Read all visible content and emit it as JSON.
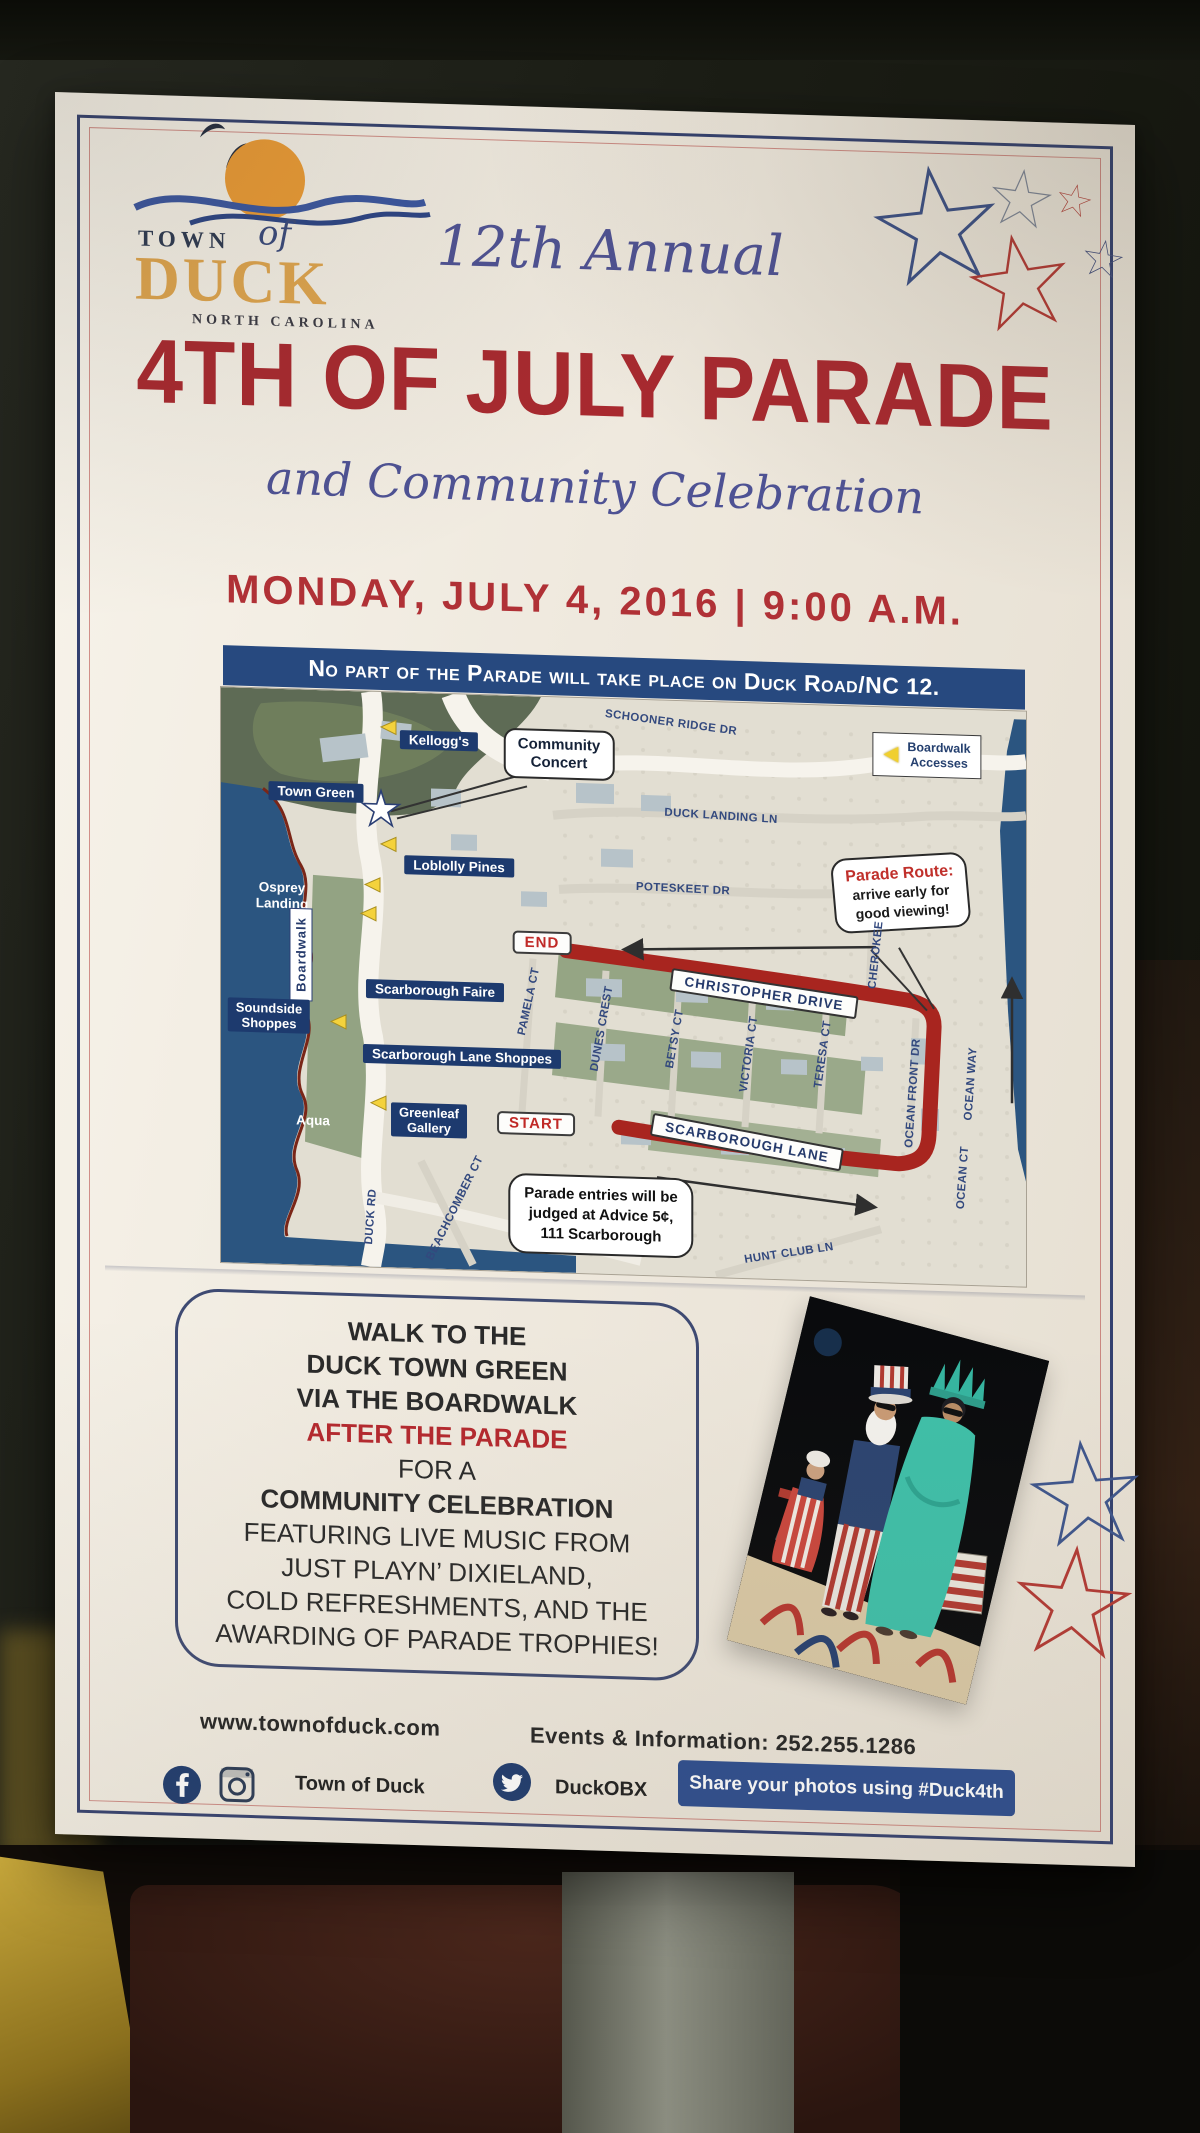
{
  "poster": {
    "logo": {
      "town": "TOWN",
      "of": "of",
      "name": "DUCK",
      "region": "NORTH CAROLINA"
    },
    "edition": "12th Annual",
    "title": "4TH OF JULY PARADE",
    "subtitle": "and Community Celebration",
    "date_line": "MONDAY, JULY 4, 2016 | 9:00 A.M.",
    "notice": "No part of the Parade will take place on Duck Road/NC 12.",
    "map": {
      "legend": {
        "line1": "Boardwalk",
        "line2": "Accesses"
      },
      "badges": {
        "end": "END",
        "start": "START"
      },
      "banners": {
        "christopher": "CHRISTOPHER DRIVE",
        "scarborough": "SCARBOROUGH LANE"
      },
      "callouts": {
        "concert": {
          "line1": "Community",
          "line2": "Concert"
        },
        "route": {
          "title": "Parade Route:",
          "line1": "arrive early for",
          "line2": "good viewing!"
        },
        "judging": {
          "line1": "Parade entries will be",
          "line2": "judged at Advice 5¢,",
          "line3": "111 Scarborough"
        }
      },
      "places": {
        "kelloggs": "Kellogg's",
        "town_green": "Town Green",
        "loblolly": "Loblolly Pines",
        "osprey": {
          "line1": "Osprey",
          "line2": "Landing"
        },
        "boardwalk": "Boardwalk",
        "soundside": {
          "line1": "Soundside",
          "line2": "Shoppes"
        },
        "faire": "Scarborough Faire",
        "lane_shoppes": "Scarborough Lane Shoppes",
        "greenleaf": {
          "line1": "Greenleaf",
          "line2": "Gallery"
        },
        "aqua": "Aqua"
      },
      "streets": {
        "schooner": "SCHOONER RIDGE DR",
        "duck_landing": "DUCK LANDING LN",
        "poteskeet": "POTESKEET DR",
        "cherokee": "CHEROKEE",
        "pamela": "PAMELA CT",
        "dunes": "DUNES CREST",
        "betsy": "BETSY CT",
        "victoria": "VICTORIA CT",
        "teresa": "TERESA CT",
        "ocean_front": "OCEAN FRONT DR",
        "ocean_way": "OCEAN WAY",
        "ocean_ct": "OCEAN CT",
        "duck_rd": "DUCK RD",
        "beachcomber": "BEACHCOMBER CT",
        "hunt_club": "HUNT CLUB LN"
      }
    },
    "celebration": {
      "lines": [
        "WALK TO THE",
        "DUCK TOWN GREEN",
        "VIA THE BOARDWALK",
        "AFTER THE PARADE",
        "FOR A",
        "COMMUNITY CELEBRATION",
        "FEATURING LIVE MUSIC FROM",
        "JUST PLAYN’ DIXIELAND,",
        "COLD REFRESHMENTS, AND THE",
        "AWARDING OF PARADE TROPHIES!"
      ]
    },
    "footer": {
      "website": "www.townofduck.com",
      "info": "Events & Information: 252.255.1286",
      "facebook_instagram_handle": "Town of Duck",
      "twitter_handle": "DuckOBX",
      "share_button": "Share your photos using #Duck4th"
    },
    "colors": {
      "navy": "#27497f",
      "title_red": "#a8292f",
      "route_red": "#a8251f",
      "script_blue": "#4e5294",
      "gold": "#dfa54e",
      "water": "#2b5580"
    }
  }
}
